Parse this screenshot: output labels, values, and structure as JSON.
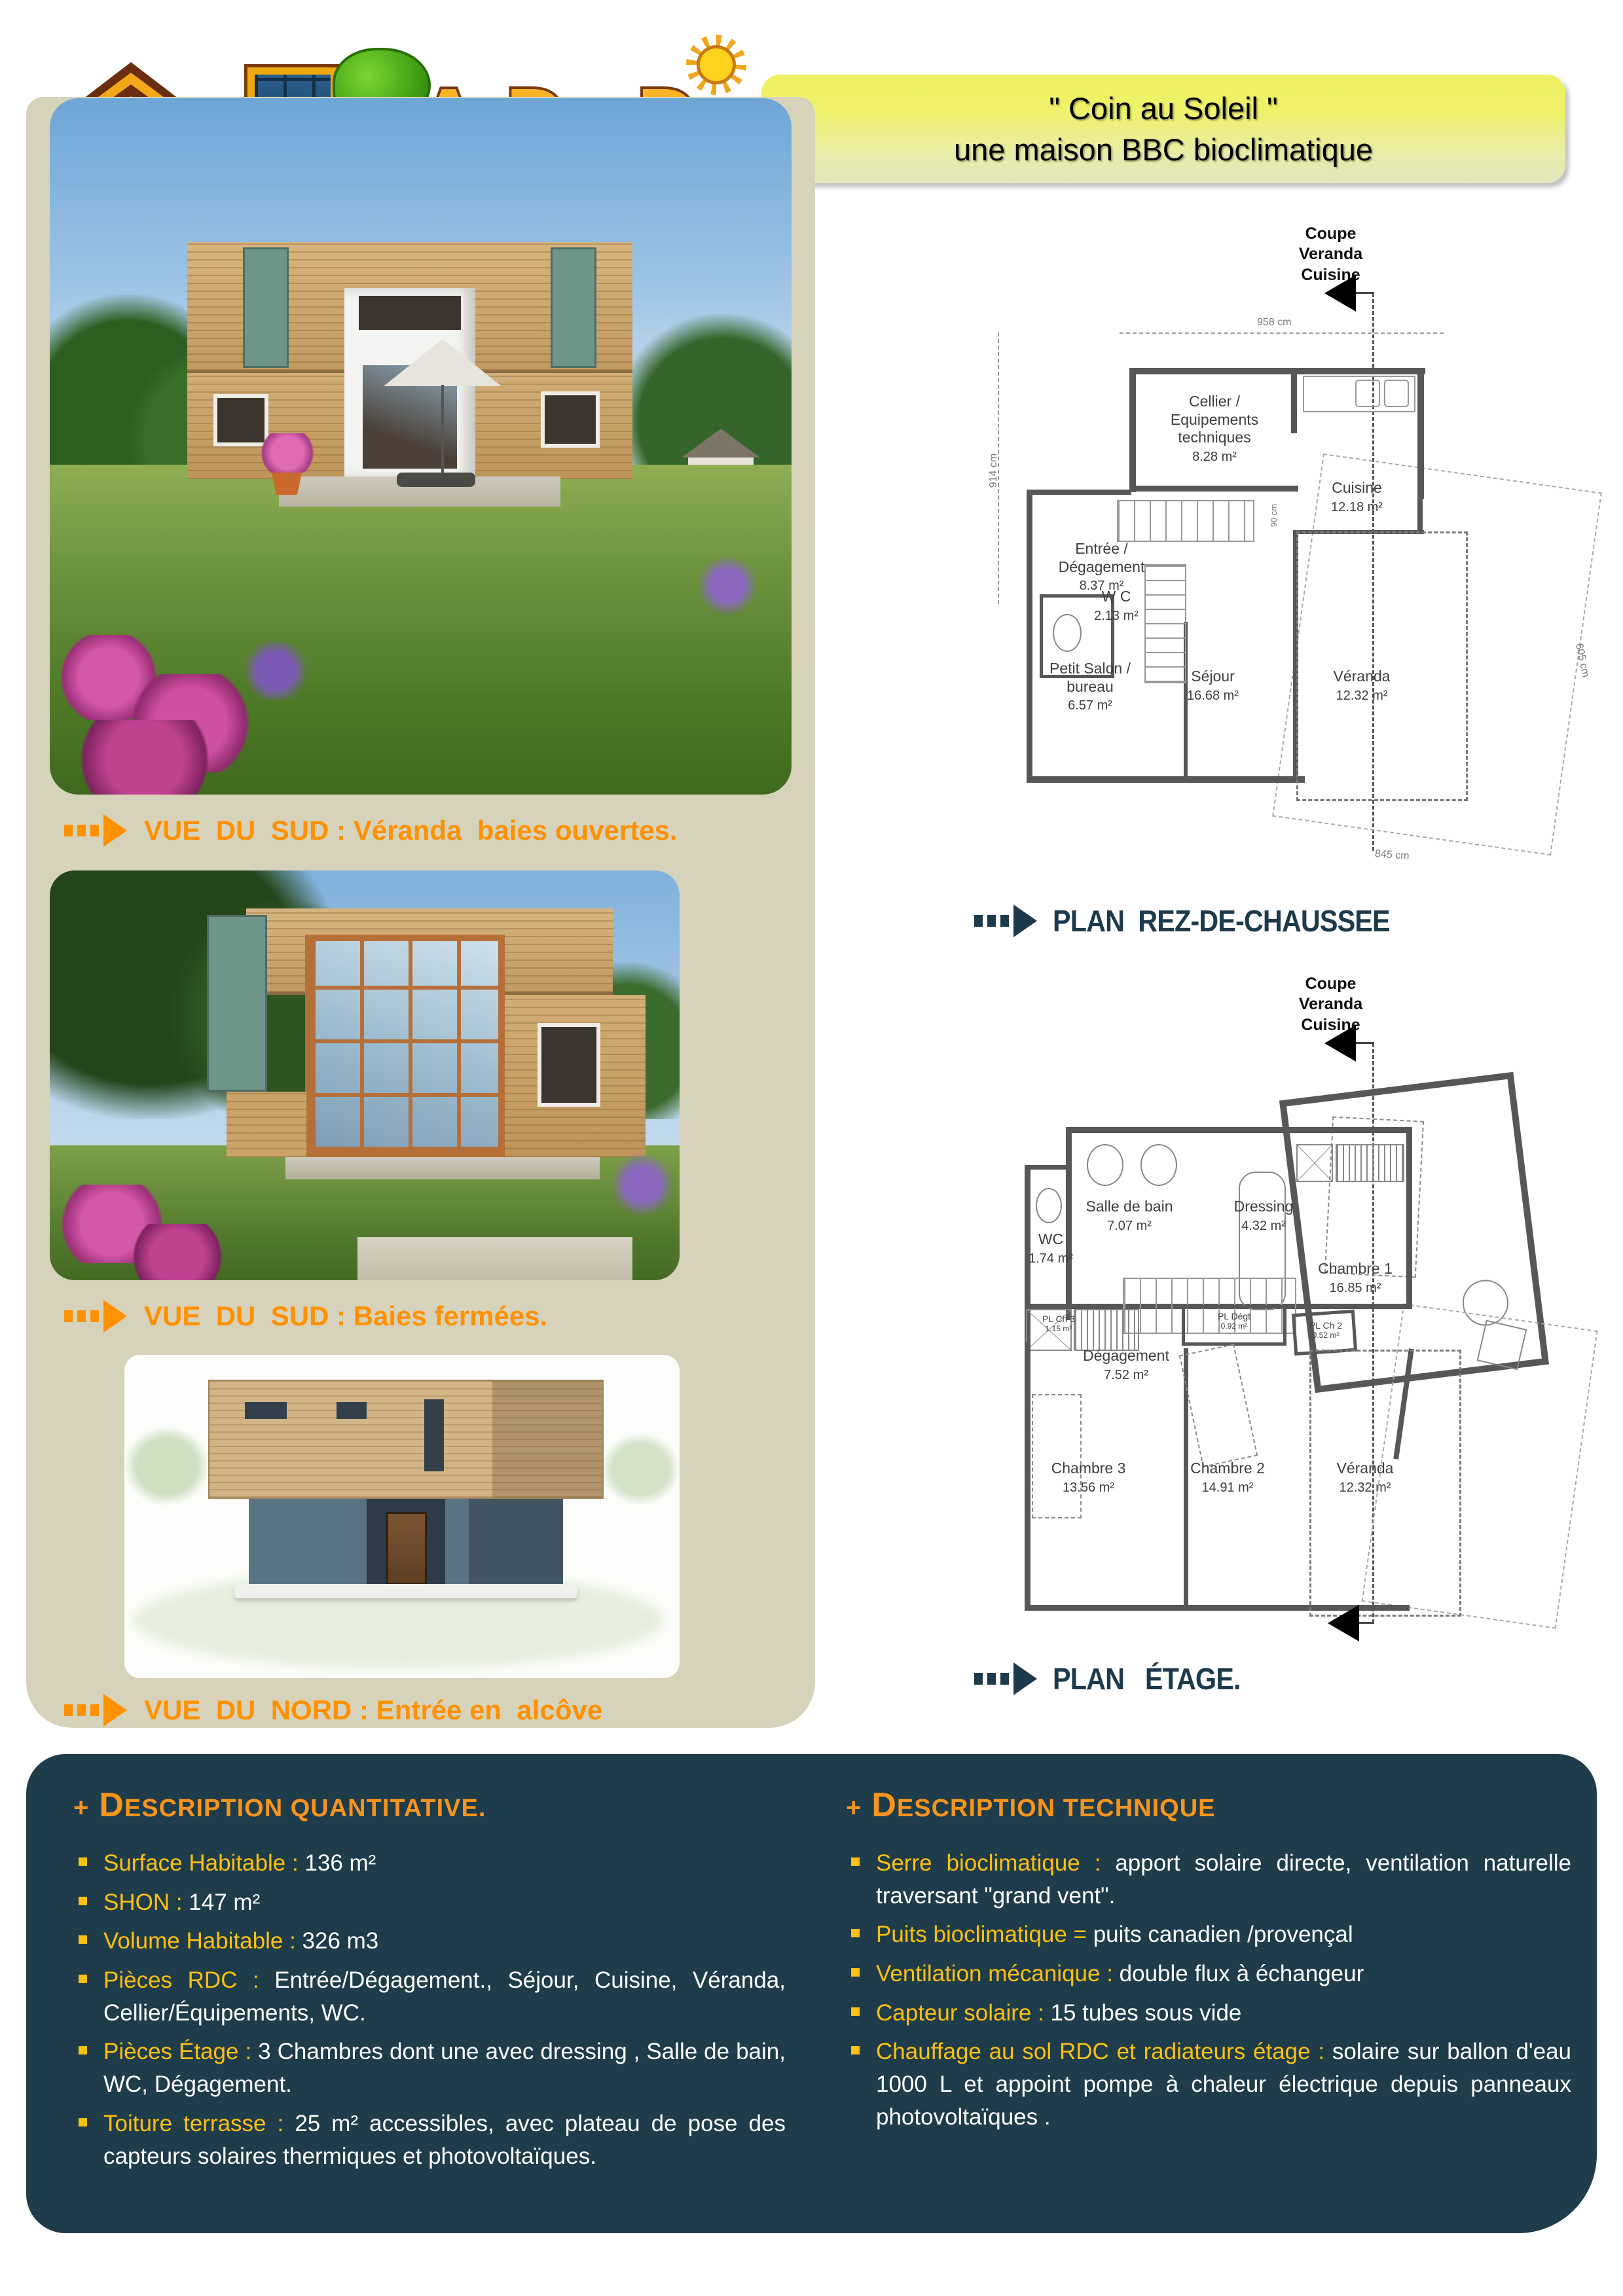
{
  "header": {
    "logo": {
      "letters": [
        "A",
        "D",
        "i",
        "D"
      ]
    },
    "banner": {
      "title": "\" Coin au Soleil \"",
      "subtitle": "une maison BBC bioclimatique"
    }
  },
  "colors": {
    "caption_orange": "#ff9100",
    "heading_orange": "#f7941d",
    "label_yellow": "#fdc013",
    "panel_teal": "#1e3c4a",
    "plan_caption_teal": "#1d3a4c",
    "photo_panel_beige": "#d7d3bb",
    "banner_yellow": "#eff26a"
  },
  "photos": [
    {
      "caption": "VUE  DU  SUD : Véranda  baies ouvertes."
    },
    {
      "caption": "VUE  DU  SUD : Baies fermées."
    },
    {
      "caption": "VUE  DU  NORD : Entrée en  alcôve"
    }
  ],
  "plans": [
    {
      "section_label": "Coupe\nVeranda\nCuisine",
      "caption": "PLAN  REZ-DE-CHAUSSEE",
      "rooms": [
        {
          "name": "Cellier /\nEquipements\ntechniques",
          "area": "8.28 m²"
        },
        {
          "name": "Cuisine",
          "area": "12.18 m²"
        },
        {
          "name": "Entrée /\nDégagement",
          "area": "8.37 m²"
        },
        {
          "name": "W C",
          "area": "2.13 m²"
        },
        {
          "name": "Petit Salon /\nbureau",
          "area": "6.57 m²"
        },
        {
          "name": "Séjour",
          "area": "16.68 m²"
        },
        {
          "name": "Véranda",
          "area": "12.32 m²"
        }
      ],
      "dimensions": {
        "top": "958 cm",
        "left": "914 cm",
        "right": "605 cm",
        "bottom": "845 cm",
        "stairs": "90 cm"
      }
    },
    {
      "section_label": "Coupe\nVeranda\nCuisine",
      "caption": "PLAN   ÉTAGE.",
      "rooms": [
        {
          "name": "Salle de bain",
          "area": "7.07 m²"
        },
        {
          "name": "WC",
          "area": "1.74 m²"
        },
        {
          "name": "Dressing",
          "area": "4.32 m²"
        },
        {
          "name": "Chambre 1",
          "area": "16.85 m²"
        },
        {
          "name": "Dégagement",
          "area": "7.52 m²"
        },
        {
          "name": "PL Dégt",
          "area": "0.92 m²"
        },
        {
          "name": "PL Ch 2",
          "area": "0.52 m²"
        },
        {
          "name": "PL Ch 3",
          "area": "1.15 m²"
        },
        {
          "name": "Chambre 3",
          "area": "13.56 m²"
        },
        {
          "name": "Chambre 2",
          "area": "14.91 m²"
        },
        {
          "name": "Véranda",
          "area": "12.32 m²"
        }
      ]
    }
  ],
  "description_quantitative": {
    "plus": "+",
    "heading": "DESCRIPTION  QUANTITATIVE.",
    "items": [
      {
        "label": "Surface Habitable : ",
        "value": "136 m²"
      },
      {
        "label": "SHON : ",
        "value": "147 m²"
      },
      {
        "label": "Volume Habitable : ",
        "value": "326 m3"
      },
      {
        "label": "Pièces RDC : ",
        "value": "Entrée/Dégagement., Séjour, Cuisine, Véranda, Cellier/Équipements, WC."
      },
      {
        "label": "Pièces Étage : ",
        "value": "3 Chambres dont une avec dressing , Salle de bain, WC, Dégagement."
      },
      {
        "label": "Toiture terrasse : ",
        "value": "25 m² accessibles, avec plateau de pose des capteurs solaires thermiques et photovoltaïques."
      }
    ]
  },
  "description_technique": {
    "plus": "+",
    "heading": "DESCRIPTION  TECHNIQUE",
    "items": [
      {
        "label": "Serre bioclimatique : ",
        "value": "apport solaire directe, ventilation naturelle traversant \"grand vent\"."
      },
      {
        "label": "Puits bioclimatique = ",
        "value": "puits  canadien /provençal"
      },
      {
        "label": "Ventilation mécanique : ",
        "value": "double flux à échangeur"
      },
      {
        "label": "Capteur solaire : ",
        "value": "15 tubes sous vide"
      },
      {
        "label": "Chauffage au sol RDC et radiateurs étage : ",
        "value": "solaire sur ballon d'eau 1000 L et  appoint pompe à chaleur  électrique depuis  panneaux photovoltaïques ."
      }
    ]
  }
}
